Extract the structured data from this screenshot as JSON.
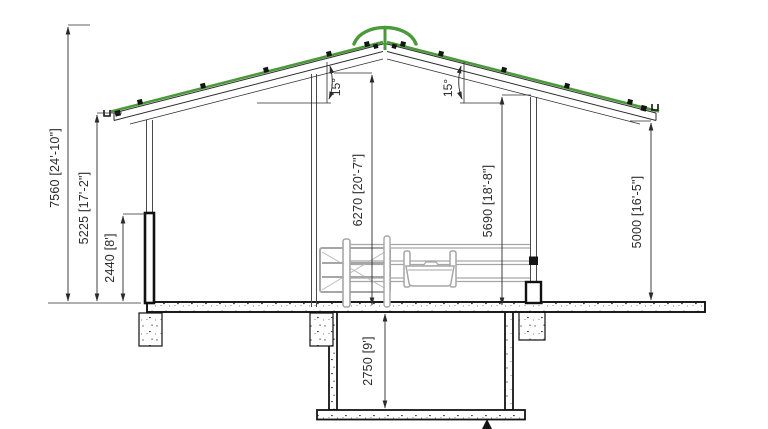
{
  "drawing": {
    "labels": {
      "overall_height": "7560 [24'-10\"]",
      "eave_height": "5225 [17'-2\"]",
      "lower_wall_height": "2440 [8']",
      "left_interior_clearance": "6270 [20'-7\"]",
      "right_interior_clearance": "5690 [18'-8\"]",
      "open_side_clearance": "5000 [16'-5\"]",
      "pit_depth": "2750 [9']",
      "left_roof_pitch": "15°",
      "right_roof_pitch": "15°"
    },
    "colors": {
      "roof_accent_green": "#4a9a3a",
      "structure_line": "#1c1c1c",
      "equipment_gray": "#a6a6a6",
      "dimension_line": "#3a3a3a",
      "background": "#ffffff"
    }
  }
}
